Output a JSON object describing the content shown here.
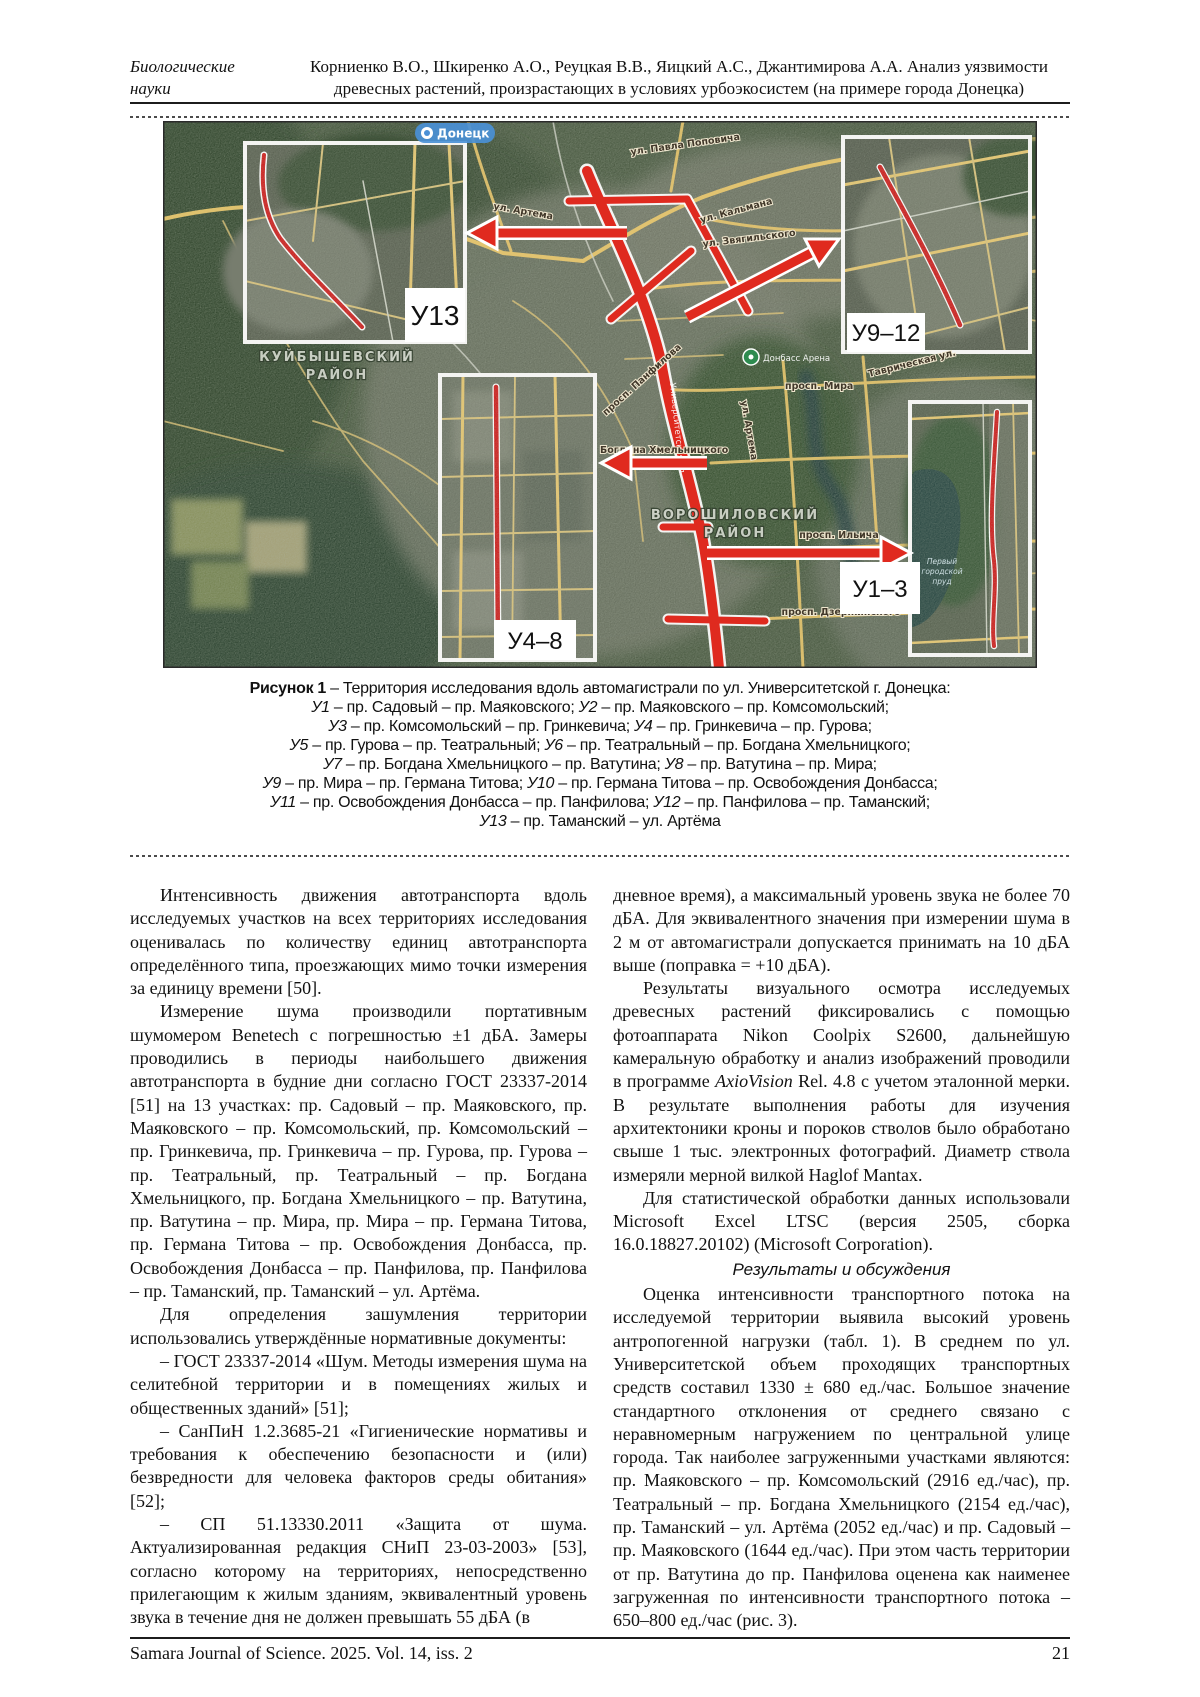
{
  "header": {
    "section_line1": "Биологические",
    "section_line2": "науки",
    "authors_line1": "Корниенко В.О., Шкиренко А.О., Реуцкая В.В., Яицкий А.С., Джантимирова А.А. Анализ уязвимости",
    "authors_line2": "древесных растений, произрастающих в условиях урбоэкосистем (на примере города Донецка)"
  },
  "figure": {
    "caption_lines": [
      [
        {
          "b": true,
          "t": "Рисунок 1"
        },
        {
          "t": " – Территория исследования вдоль автомагистрали по ул. Университетской г. Донецка:"
        }
      ],
      [
        {
          "em": true,
          "t": "У1"
        },
        {
          "t": " – пр. Садовый – пр. Маяковского; "
        },
        {
          "em": true,
          "t": "У2"
        },
        {
          "t": " – пр. Маяковского – пр. Комсомольский;"
        }
      ],
      [
        {
          "em": true,
          "t": "У3"
        },
        {
          "t": " – пр. Комсомольский – пр. Гринкевича; "
        },
        {
          "em": true,
          "t": "У4"
        },
        {
          "t": " – пр. Гринкевича – пр. Гурова;"
        }
      ],
      [
        {
          "em": true,
          "t": "У5"
        },
        {
          "t": " – пр. Гурова – пр. Театральный; "
        },
        {
          "em": true,
          "t": "У6"
        },
        {
          "t": " – пр. Театральный – пр. Богдана Хмельницкого;"
        }
      ],
      [
        {
          "em": true,
          "t": "У7"
        },
        {
          "t": " – пр. Богдана Хмельницкого – пр. Ватутина; "
        },
        {
          "em": true,
          "t": "У8"
        },
        {
          "t": " – пр. Ватутина – пр. Мира;"
        }
      ],
      [
        {
          "em": true,
          "t": "У9"
        },
        {
          "t": " – пр. Мира – пр. Германа Титова; "
        },
        {
          "em": true,
          "t": "У10"
        },
        {
          "t": " – пр. Германа Титова – пр. Освобождения Донбасса;"
        }
      ],
      [
        {
          "em": true,
          "t": "У11"
        },
        {
          "t": " – пр. Освобождения Донбасса – пр. Панфилова; "
        },
        {
          "em": true,
          "t": "У12"
        },
        {
          "t": " – пр. Панфилова – пр. Таманский;"
        }
      ],
      [
        {
          "em": true,
          "t": "У13"
        },
        {
          "t": " – пр. Таманский – ул. Артёма"
        }
      ]
    ]
  },
  "map": {
    "accent_route_color": "#df2a1f",
    "road_color": "#e7c771",
    "insets": [
      {
        "label": "У13"
      },
      {
        "label": "У9–12"
      },
      {
        "label": "У4–8"
      },
      {
        "label": "У1–3"
      }
    ],
    "street_labels": [
      "Донецк",
      "ул. Артема",
      "ул. Павла Поповича",
      "ул. Кальмана",
      "ул. Звягильского",
      "Донбасс Арена",
      "ВОРОШИЛОВСКИЙ",
      "РАЙОН",
      "КУЙБЫШЕВСКИЙ",
      "РАЙОН",
      "просп. Мира",
      "просп. Ильича",
      "просп. Дзержинского",
      "Таврическая ул.",
      "Богдана Хмельницкого",
      "просп. Панфилова",
      "Первый",
      "городской",
      "пруд",
      "ул. Артема",
      "Университетская ул."
    ]
  },
  "body": {
    "left": [
      {
        "name": "paragraph",
        "segs": [
          {
            "t": "Интенсивность движения автотранспорта вдоль исследуемых участков на всех территориях исследования оценивалась по количеству единиц автотранспорта определённого типа, проезжающих мимо точки измерения за единицу времени [50]."
          }
        ]
      },
      {
        "name": "paragraph",
        "segs": [
          {
            "t": "Измерение шума производили портативным шумомером Benetech с погрешностью ±1 дБА. Замеры проводились в периоды наибольшего движения автотранспорта в будние дни согласно ГОСТ 23337-2014 [51] на 13 участках: пр. Садовый – пр. Маяковского, пр. Маяковского – пр. Комсомольский, пр. Комсомольский – пр. Гринкевича, пр. Гринкевича – пр. Гурова, пр. Гурова – пр. Театральный, пр. Театральный – пр. Богдана Хмельницкого, пр. Богдана Хмельницкого – пр. Ватутина, пр. Ватутина – пр. Мира, пр. Мира – пр. Германа Титова, пр. Германа Титова – пр. Освобождения Донбасса, пр. Освобождения Донбасса – пр. Панфилова, пр. Панфилова – пр. Таманский, пр. Таманский – ул. Артёма."
          }
        ]
      },
      {
        "name": "paragraph",
        "segs": [
          {
            "t": "Для определения зашумления территории использовались утверждённые нормативные документы:"
          }
        ]
      },
      {
        "name": "paragraph",
        "segs": [
          {
            "t": "– ГОСТ 23337-2014 «Шум. Методы измерения шума на селитебной территории и в помещениях жилых и общественных зданий» [51];"
          }
        ]
      },
      {
        "name": "paragraph",
        "segs": [
          {
            "t": "– СанПиН 1.2.3685-21 «Гигиенические нормативы и требования к обеспечению безопасности и (или) безвредности для человека факторов среды обитания» [52];"
          }
        ]
      },
      {
        "name": "paragraph",
        "segs": [
          {
            "t": "– СП 51.13330.2011 «Защита от шума. Актуализированная редакция СНиП 23-03-2003» [53], согласно которому на территориях, непосредственно прилегающим к жилым зданиям, эквивалентный уровень звука в течение дня не должен превышать 55 дБА (в"
          }
        ]
      }
    ],
    "right": [
      {
        "name": "paragraph",
        "cls": "noindent",
        "segs": [
          {
            "t": "дневное время), а максимальный уровень звука не более 70 дБА. Для эквивалентного значения при измерении шума в 2 м от автомагистрали допускается принимать на 10 дБА выше (поправка = +10 дБА)."
          }
        ]
      },
      {
        "name": "paragraph",
        "segs": [
          {
            "t": "Результаты визуального осмотра исследуемых древесных растений фиксировались с помощью фотоаппарата Nikon Coolpix S2600, дальнейшую камеральную обработку и анализ изображений проводили в программе "
          },
          {
            "em": true,
            "t": "AxioVision"
          },
          {
            "t": " Rel. 4.8 с учетом эталонной мерки. В результате выполнения работы для изучения архитектоники кроны и пороков стволов было обработано свыше 1 тыс. электронных фотографий. Диаметр ствола измеряли мерной вилкой Haglof Mantax."
          }
        ]
      },
      {
        "name": "paragraph",
        "segs": [
          {
            "t": "Для статистической обработки данных использовали Microsoft Excel LTSC (версия 2505, сборка 16.0.18827.20102) (Microsoft Corporation)."
          }
        ]
      },
      {
        "name": "section-heading",
        "cls": "center-head",
        "segs": [
          {
            "em": true,
            "t": "Результаты и обсуждения"
          }
        ]
      },
      {
        "name": "paragraph",
        "segs": [
          {
            "t": "Оценка интенсивности транспортного потока на исследуемой территории выявила высокий уровень антропогенной нагрузки (табл. 1). В среднем по ул. Университетской объем проходящих транспортных средств составил 1330 ± 680 ед./час. Большое значение стандартного отклонения от среднего связано с неравномерным нагружением по центральной улице города. Так наиболее загруженными участками являются: пр. Маяковского – пр. Комсомольский (2916 ед./час), пр. Театральный – пр. Богдана Хмельницкого (2154 ед./час), пр. Таманский – ул. Артёма (2052 ед./час) и пр. Садовый – пр. Маяковского (1644 ед./час). При этом часть территории от пр. Ватутина до пр. Панфилова оценена как наименее загруженная по интенсивности транспортного потока – 650–800 ед./час (рис. 3)."
          }
        ]
      }
    ]
  },
  "footer": {
    "journal": "Samara Journal of Science. 2025. Vol. 14, iss. 2",
    "page": "21"
  }
}
